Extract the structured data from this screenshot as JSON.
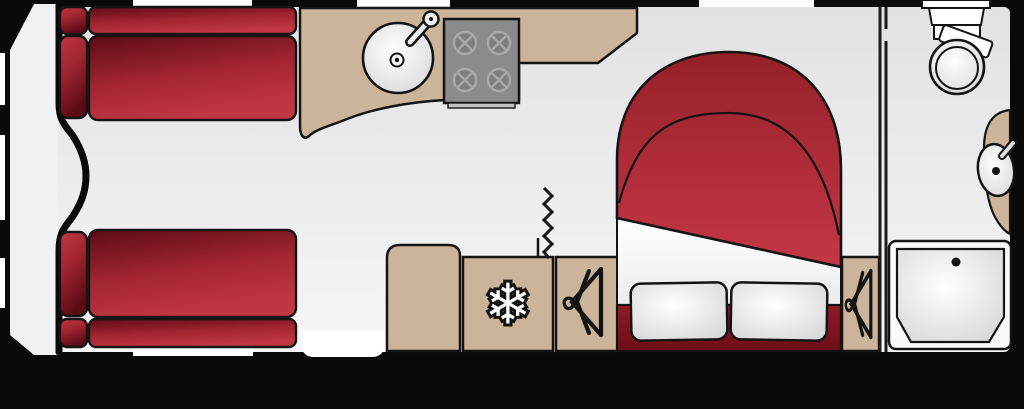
{
  "diagram_type": "caravan-floorplan",
  "colors": {
    "background": "#0a0a0a",
    "outline": "#141414",
    "floor_top": "#e2e2e4",
    "floor_bottom": "#f6f6f7",
    "front_area": "#f1f1f2",
    "wood": "#cbb499",
    "red_dark": "#5c0b14",
    "red_mid": "#a22532",
    "red_bright": "#c13643",
    "duvet_top": "#952029",
    "duvet_bottom": "#c53746",
    "base_top": "#8f1b26",
    "base_bottom": "#6d0e17",
    "white": "#ffffff",
    "white_shade": "#d6d6d8",
    "sheet_bottom": "#ececee",
    "hob_body": "#8b8b8b",
    "hob_burner": "#7e7e7e",
    "hob_ring": "#a8a8a8",
    "hob_lip": "#c2c2c2",
    "window": "#ffffff",
    "wall_line": "#1c1c1c"
  },
  "icons": {
    "snowflake": {
      "glyph": "❄",
      "name": "snowflake-icon",
      "meaning": "fridge"
    },
    "hanger": {
      "name": "coat-hanger-icon",
      "meaning": "wardrobe"
    }
  },
  "items": [
    "front-lounge-sofa-top",
    "front-lounge-sofa-bottom",
    "front-chest-curve",
    "kitchen-worktop",
    "kitchen-sink",
    "kitchen-hob",
    "entrance-door",
    "mid-cabinet",
    "fridge",
    "wardrobe-left",
    "concertina-door",
    "island-bed",
    "pillow-left",
    "pillow-right",
    "wardrobe-right",
    "partition-wall",
    "toilet",
    "vanity-unit",
    "washbasin",
    "shower-tray"
  ],
  "windows": {
    "top_wall": 3,
    "bottom_wall": 1,
    "front_wall": 3
  }
}
